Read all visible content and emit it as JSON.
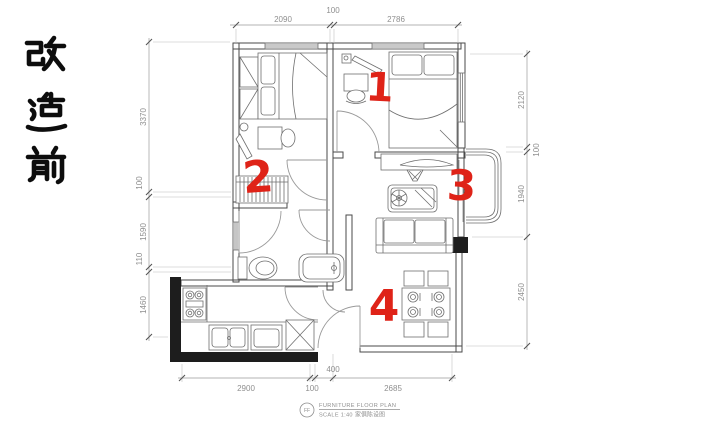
{
  "side_label": {
    "text": "改造前",
    "color": "#0d0d0d"
  },
  "room_markers": {
    "color": "#df2318",
    "items": [
      {
        "n": "1"
      },
      {
        "n": "2"
      },
      {
        "n": "3"
      },
      {
        "n": "4"
      }
    ]
  },
  "dimensions": {
    "top": [
      {
        "label": "2090"
      },
      {
        "label": "100"
      },
      {
        "label": "2786"
      }
    ],
    "left": [
      {
        "label": "3370"
      },
      {
        "label": "100"
      },
      {
        "label": "1590"
      },
      {
        "label": "110"
      },
      {
        "label": "1460"
      }
    ],
    "right": [
      {
        "label": "2120"
      },
      {
        "label": "100"
      },
      {
        "label": "1940"
      },
      {
        "label": "2450"
      }
    ],
    "bottom": [
      {
        "label": "2900"
      },
      {
        "label": "100"
      },
      {
        "label": "400"
      },
      {
        "label": "2685"
      }
    ]
  },
  "title_block": {
    "circle_label": "FF",
    "title": "FURNITURE FLOOR PLAN",
    "scale": "SCALE 1:40",
    "scale_cn": "家俱陈设图"
  },
  "colors": {
    "wall": "#4a4a4a",
    "thick_wall": "#1d1d1d",
    "annotation_red": "#df2318",
    "dimension_text": "#8f8f8f",
    "background": "#ffffff"
  }
}
